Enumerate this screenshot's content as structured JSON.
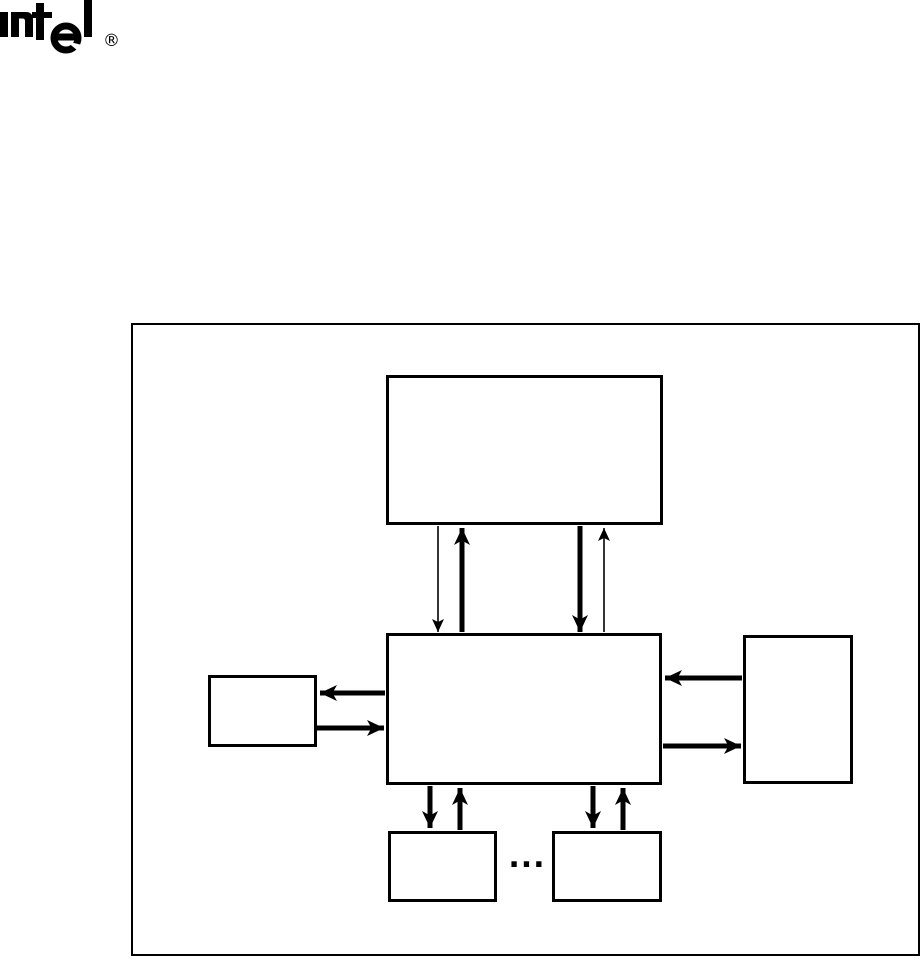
{
  "page": {
    "background_color": "#ffffff",
    "ink_color": "#000000"
  },
  "logo": {
    "word": "intel",
    "registered": "®"
  },
  "figure": {
    "ellipsis": "...",
    "boxes": [
      {
        "id": "top-box",
        "label": ""
      },
      {
        "id": "center-box",
        "label": ""
      },
      {
        "id": "left-box",
        "label": ""
      },
      {
        "id": "right-box",
        "label": ""
      },
      {
        "id": "bottom-box-1",
        "label": ""
      },
      {
        "id": "bottom-box-2",
        "label": ""
      }
    ]
  }
}
